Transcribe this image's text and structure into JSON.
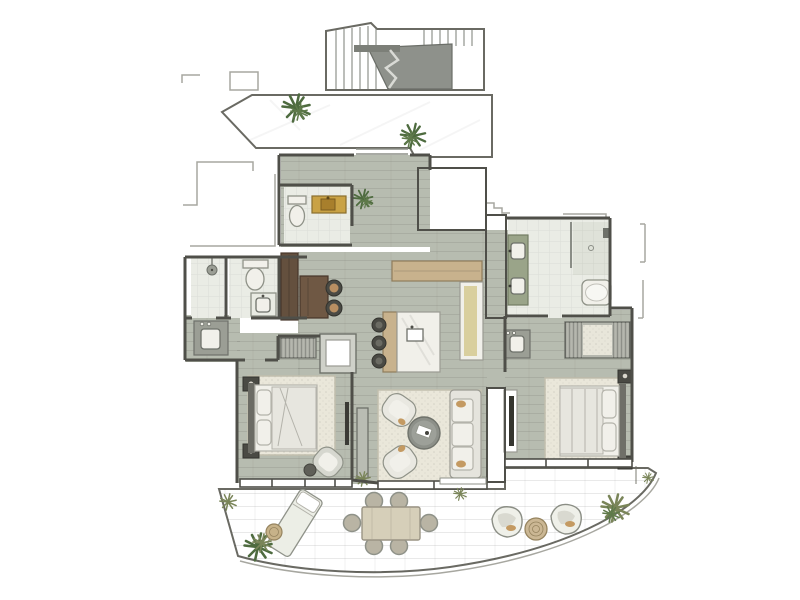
{
  "plan": {
    "title": "apartment-floor-plan",
    "rooms": [
      {
        "id": "stairwell",
        "name": "common stairwell",
        "features": [
          "stair-treads",
          "stair-void",
          "handrail",
          "break-line"
        ]
      },
      {
        "id": "upper-terrace",
        "name": "upper terrace walkway",
        "features": [
          "stone-paving",
          "potted-plant",
          "potted-plant",
          "entry-steps"
        ]
      },
      {
        "id": "entry-hall",
        "name": "entry hall",
        "features": [
          "wood-floor",
          "potted-plant"
        ]
      },
      {
        "id": "powder-room",
        "name": "powder room",
        "features": [
          "toilet",
          "yellow-vanity-with-sink",
          "tile-floor"
        ]
      },
      {
        "id": "utility-room",
        "name": "utility / elevator room",
        "features": [
          "plain-gray-floor"
        ]
      },
      {
        "id": "shower-room",
        "name": "shower room",
        "features": [
          "shower-head",
          "tile-floor"
        ]
      },
      {
        "id": "wc-room",
        "name": "wc",
        "features": [
          "toilet",
          "washbasin",
          "tile-floor"
        ]
      },
      {
        "id": "vanity-nook",
        "name": "vanity nook",
        "features": [
          "washbasin-cabinet"
        ]
      },
      {
        "id": "office-nook",
        "name": "study nook",
        "features": [
          "tall-cabinet",
          "walnut-desk",
          "two-chairs"
        ]
      },
      {
        "id": "kitchen",
        "name": "open kitchen",
        "features": [
          "l-shaped-counter",
          "island-with-sink",
          "three-stools",
          "appliance-column"
        ]
      },
      {
        "id": "living-room",
        "name": "living room",
        "features": [
          "rug",
          "sofa-3-seat",
          "two-armchairs",
          "round-coffee-table",
          "media-console",
          "grass-plant"
        ]
      },
      {
        "id": "bedroom-2",
        "name": "bedroom 2",
        "features": [
          "double-bed",
          "two-nightstands",
          "rug",
          "armchair",
          "ottoman",
          "wardrobe",
          "tv"
        ]
      },
      {
        "id": "master-bedroom",
        "name": "master bedroom",
        "features": [
          "double-bed",
          "two-nightstands",
          "rug",
          "walk-in-wardrobe",
          "tv-panel",
          "basin-cabinet"
        ]
      },
      {
        "id": "master-bathroom",
        "name": "master bathroom",
        "features": [
          "double-green-vanity",
          "walk-in-shower",
          "bathtub",
          "tile-floor"
        ]
      },
      {
        "id": "lower-terrace",
        "name": "curved lower terrace",
        "features": [
          "sun-lounger",
          "side-table",
          "outdoor-dining-table-6-chairs",
          "two-lounge-chairs",
          "round-table",
          "plants",
          "stone-pavers"
        ]
      }
    ]
  },
  "palette": {
    "wall": "#4f4f49",
    "ghost_line": "#a7a7a0",
    "wood_floor": "#b7bcb0",
    "tile_floor": "#eaece5",
    "tile_dark": "#dfe2d9",
    "terrace_stone": "#cfd2c9",
    "stair": "#c9cbc4",
    "stair_void": "#8e918b",
    "paver": "#c9cbc1",
    "utility_gray": "#c6c9c1",
    "rug_cream": "#eae7da",
    "fabric_white": "#f1f0ea",
    "wood_light": "#c8b28d",
    "wood_dark": "#64503e",
    "accent_yellow": "#c9a245",
    "sink_yellow": "#a87f2c",
    "vanity_green": "#9aa489",
    "counter_band": "#d9cf9e",
    "plant_green": "#4e6b3f",
    "grass_olive": "#7a8559",
    "tan_accent": "#c49a62",
    "charcoal": "#3b3b36"
  }
}
